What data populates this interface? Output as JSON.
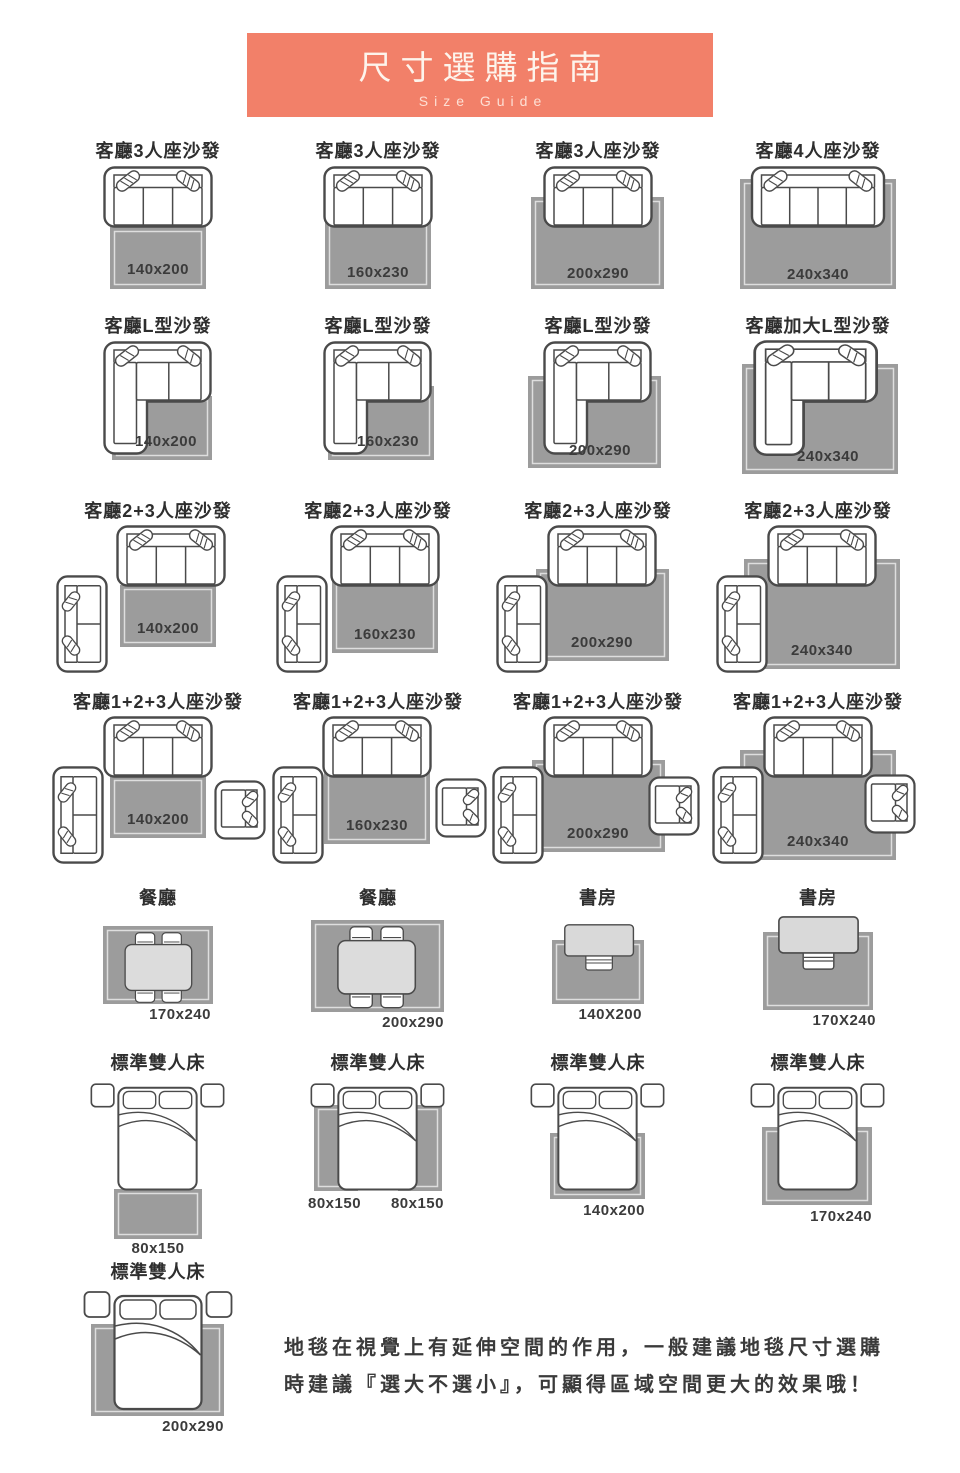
{
  "header": {
    "title": "尺寸選購指南",
    "subtitle": "Size Guide"
  },
  "rows": [
    {
      "cells": [
        {
          "title": "客廳3人座沙發",
          "size": "140x200"
        },
        {
          "title": "客廳3人座沙發",
          "size": "160x230"
        },
        {
          "title": "客廳3人座沙發",
          "size": "200x290"
        },
        {
          "title": "客廳4人座沙發",
          "size": "240x340"
        }
      ]
    },
    {
      "cells": [
        {
          "title": "客廳L型沙發",
          "size": "140x200"
        },
        {
          "title": "客廳L型沙發",
          "size": "160x230"
        },
        {
          "title": "客廳L型沙發",
          "size": "200x290"
        },
        {
          "title": "客廳加大L型沙發",
          "size": "240x340"
        }
      ]
    },
    {
      "cells": [
        {
          "title": "客廳2+3人座沙發",
          "size": "140x200"
        },
        {
          "title": "客廳2+3人座沙發",
          "size": "160x230"
        },
        {
          "title": "客廳2+3人座沙發",
          "size": "200x290"
        },
        {
          "title": "客廳2+3人座沙發",
          "size": "240x340"
        }
      ]
    },
    {
      "cells": [
        {
          "title": "客廳1+2+3人座沙發",
          "size": "140x200"
        },
        {
          "title": "客廳1+2+3人座沙發",
          "size": "160x230"
        },
        {
          "title": "客廳1+2+3人座沙發",
          "size": "200x290"
        },
        {
          "title": "客廳1+2+3人座沙發",
          "size": "240x340"
        }
      ]
    },
    {
      "cells": [
        {
          "title": "餐廳",
          "size": "170x240"
        },
        {
          "title": "餐廳",
          "size": "200x290"
        },
        {
          "title": "書房",
          "size": "140X200"
        },
        {
          "title": "書房",
          "size": "170X240"
        }
      ]
    },
    {
      "cells": [
        {
          "title": "標準雙人床",
          "size": "80x150"
        },
        {
          "title": "標準雙人床",
          "size": "80x150",
          "size2": "80x150"
        },
        {
          "title": "標準雙人床",
          "size": "140x200"
        },
        {
          "title": "標準雙人床",
          "size": "170x240"
        }
      ]
    },
    {
      "cells": [
        {
          "title": "標準雙人床",
          "size": "200x290"
        }
      ]
    }
  ],
  "note": "地毯在視覺上有延伸空間的作用，一般建議地毯尺寸選購時建議『選大不選小』，可顯得區域空間更大的效果哦！",
  "icons": {
    "sofa3": "sofa-3seat-top-view-icon",
    "sofa4": "sofa-4seat-top-view-icon",
    "lsofa": "l-shape-sofa-top-view-icon",
    "loveseat": "loveseat-2seat-top-view-icon",
    "armchair": "armchair-top-view-icon",
    "dining": "dining-table-chairs-top-view-icon",
    "study": "desk-chair-top-view-icon",
    "bed": "double-bed-top-view-icon",
    "rug": "gray-rug"
  },
  "colors": {
    "accent": "#F28069",
    "rug": "#9C9C9C",
    "outline": "#4A4A4A",
    "furniture_light": "#DCDCDC",
    "text": "#2E2E2E"
  }
}
